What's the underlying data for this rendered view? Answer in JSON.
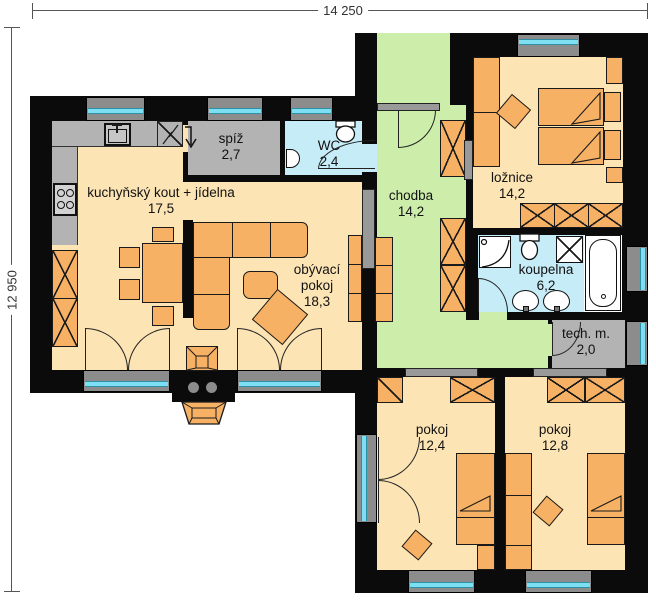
{
  "plan": {
    "dimensions": {
      "width": "14 250",
      "height": "12 950"
    },
    "rooms": {
      "kitchen": {
        "name": "kuchyňský kout + jídelna",
        "area": "17,5"
      },
      "pantry": {
        "name": "spíž",
        "area": "2,7"
      },
      "wc": {
        "name": "WC",
        "area": "2,4"
      },
      "living": {
        "name": "obývací pokoj",
        "area": "18,3"
      },
      "hall": {
        "name": "chodba",
        "area": "14,2"
      },
      "bedroom": {
        "name": "ložnice",
        "area": "14,2"
      },
      "bath": {
        "name": "koupelna",
        "area": "6,2"
      },
      "tech": {
        "name": "tech. m.",
        "area": "2,0"
      },
      "room1": {
        "name": "pokoj",
        "area": "12,4"
      },
      "room2": {
        "name": "pokoj",
        "area": "12,8"
      }
    },
    "colors": {
      "wall": "#0b0b0b",
      "floor_warm": "#fce4b4",
      "floor_green": "#cdeeab",
      "floor_cyan": "#c6ecf8",
      "floor_gray": "#b3b3b3",
      "furniture": "#f6b165",
      "glass": "#7ddff2"
    }
  }
}
